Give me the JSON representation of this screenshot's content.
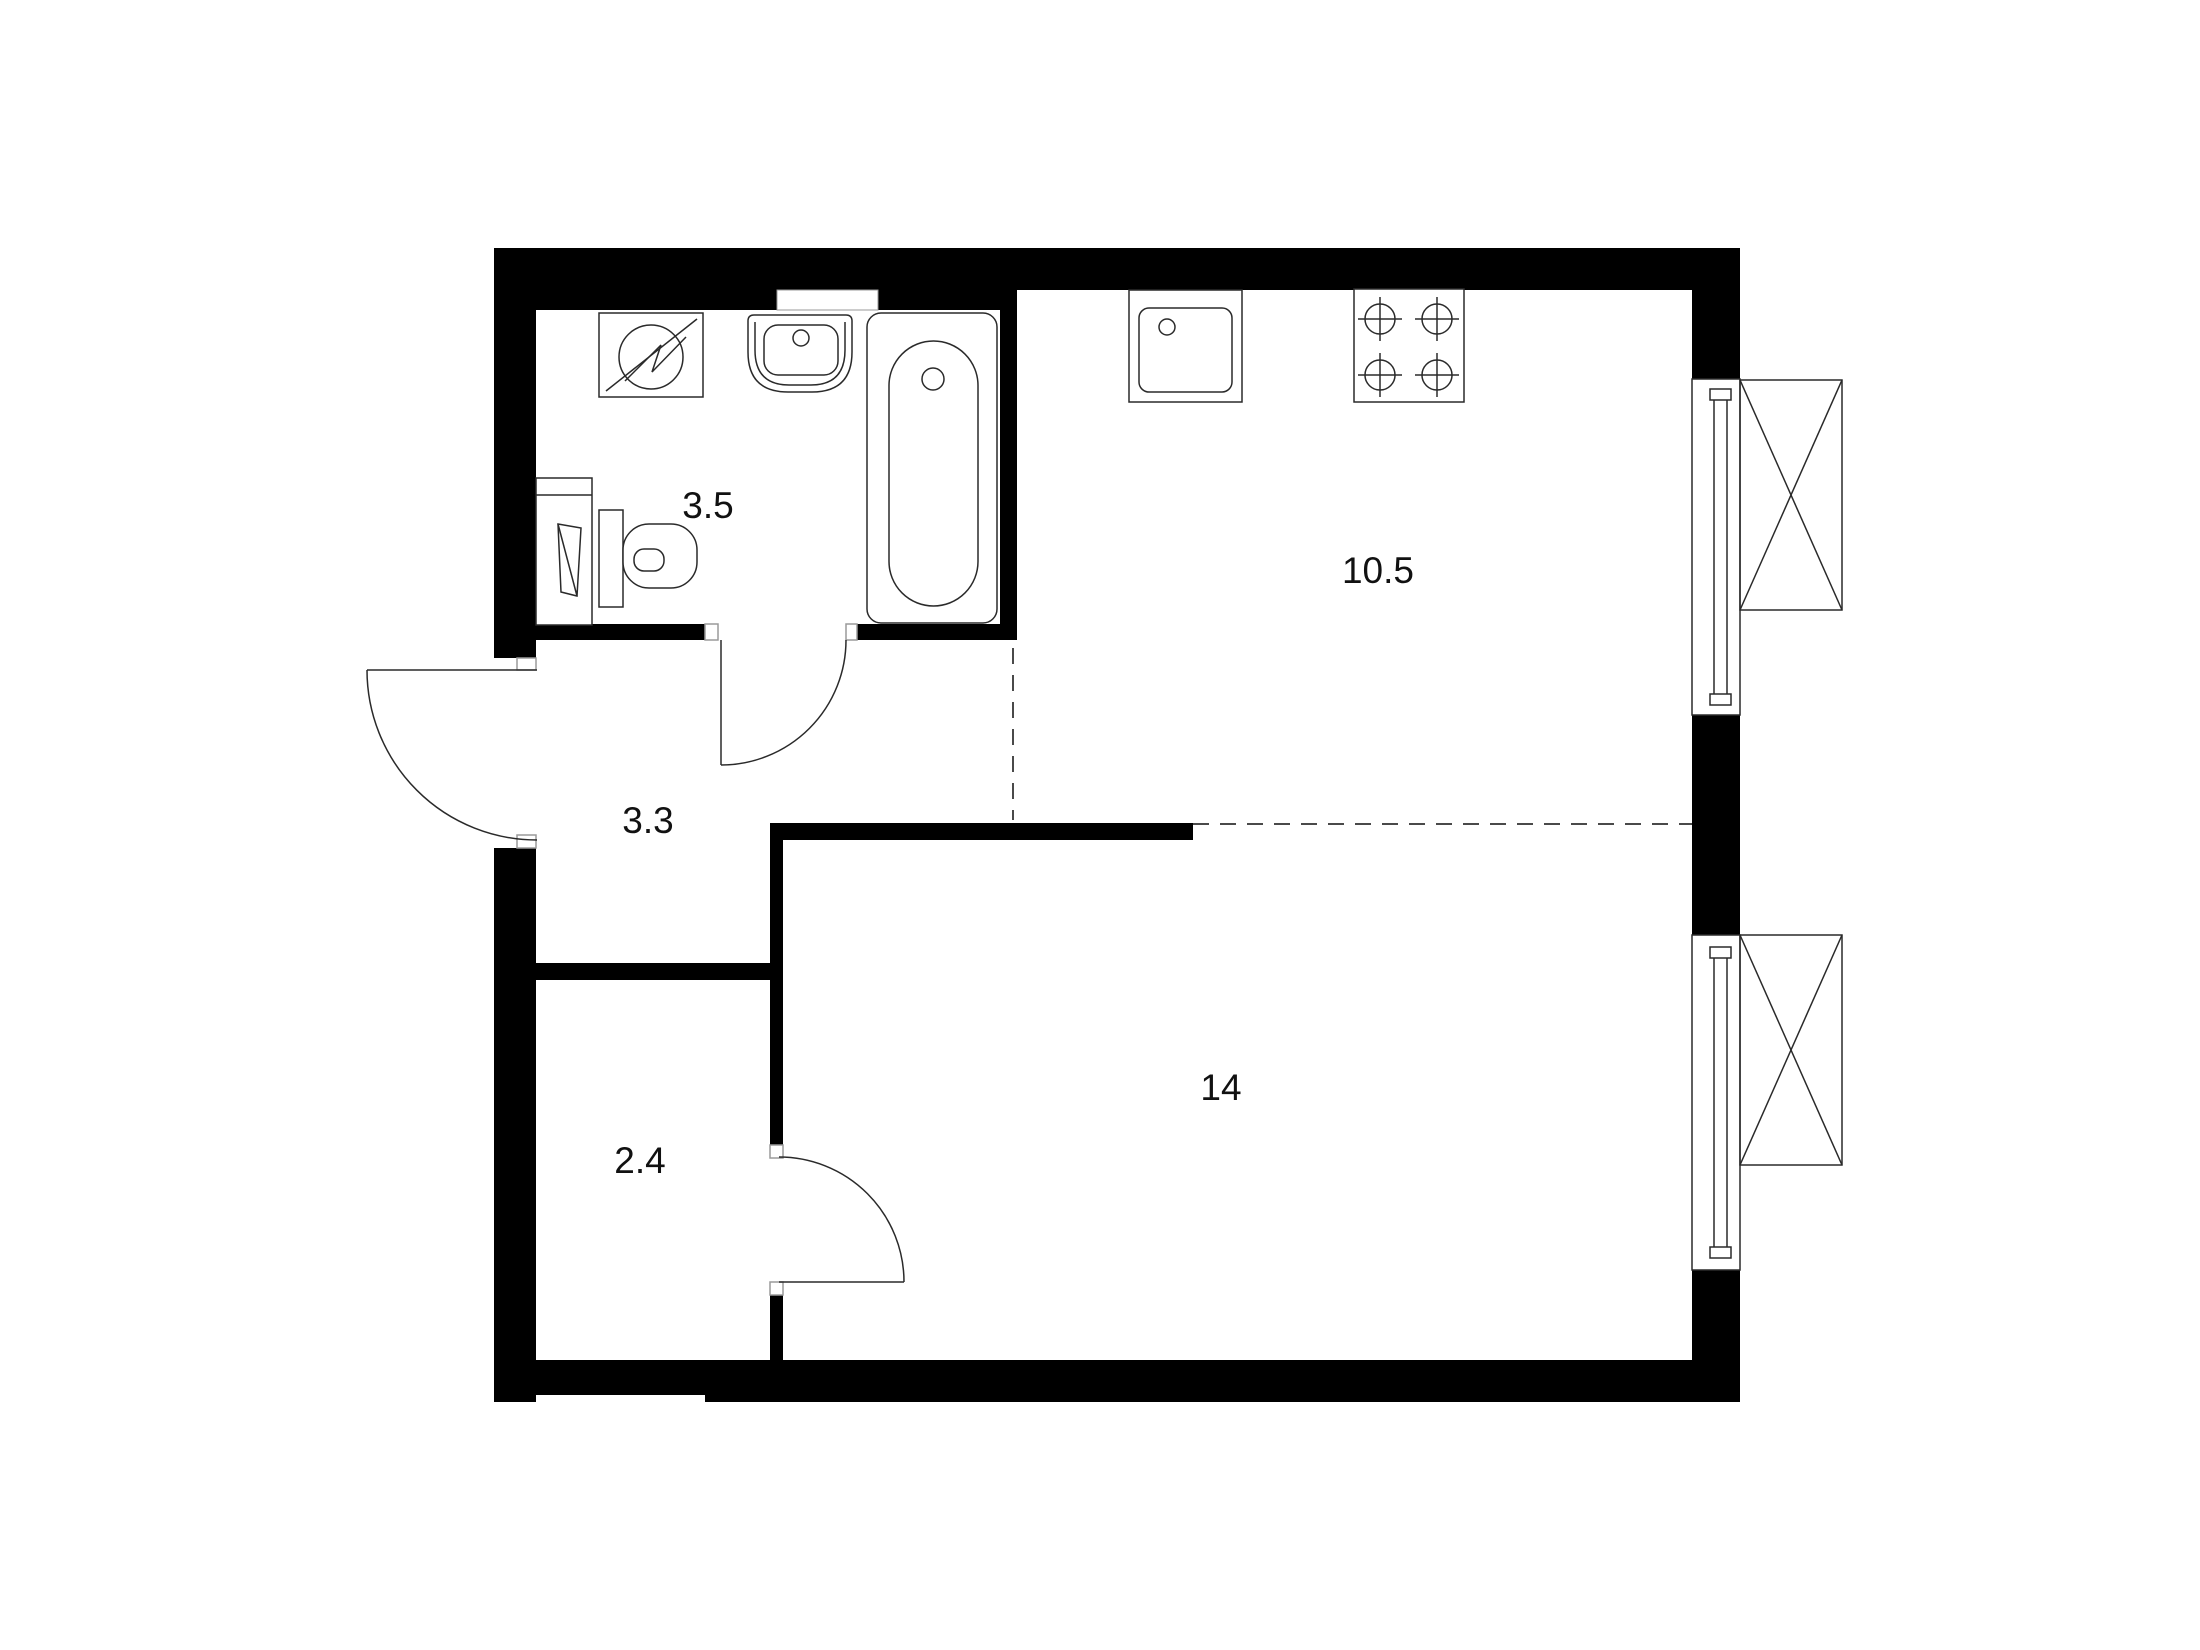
{
  "page": {
    "background": "#ffffff"
  },
  "plan": {
    "rooms": [
      {
        "id": "bathroom",
        "area_label": "3.5"
      },
      {
        "id": "kitchen",
        "area_label": "10.5"
      },
      {
        "id": "hallway",
        "area_label": "3.3"
      },
      {
        "id": "closet",
        "area_label": "2.4"
      },
      {
        "id": "living-room",
        "area_label": "14"
      }
    ],
    "fixtures": [
      "washing-machine-icon",
      "bathroom-sink-icon",
      "bathtub-icon",
      "toilet-icon",
      "bathroom-cabinet-icon",
      "kitchen-sink-icon",
      "stove-4-burner-icon",
      "window-icon",
      "window-icon",
      "ac-unit-icon",
      "ac-unit-icon",
      "door-swing-icon",
      "door-swing-icon",
      "door-swing-icon"
    ],
    "colors": {
      "wall": "#000000",
      "outline": "#2a2a2a",
      "dashed_boundary": "#4a4a4a",
      "jamb": "#9a9a9a",
      "label": "#111111"
    }
  }
}
